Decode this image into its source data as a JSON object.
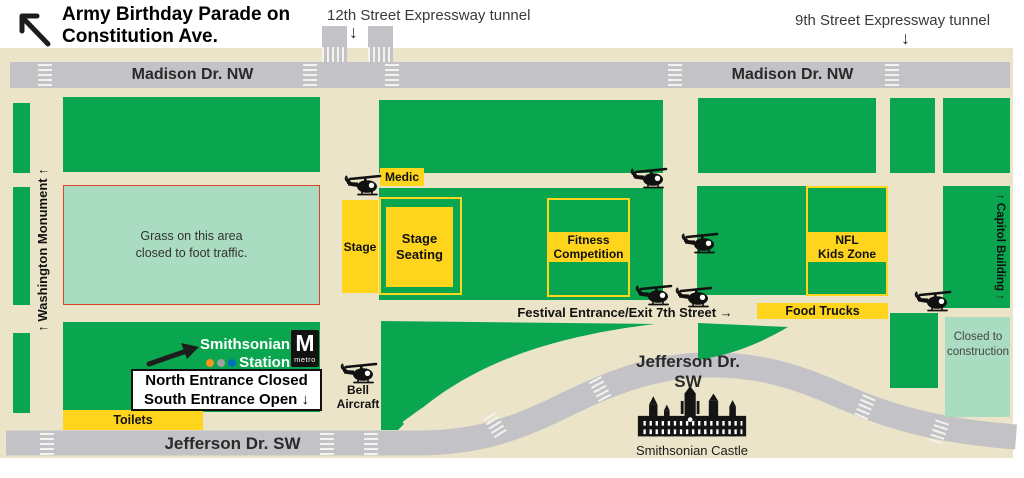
{
  "title": {
    "line1": "Army Birthday Parade on",
    "line2": "Constitution Ave."
  },
  "tunnels": {
    "t12": "12th Street Expressway tunnel",
    "t9": "9th Street Expressway tunnel",
    "down_arrow": "↓"
  },
  "streets": {
    "madison_left": "Madison Dr. NW",
    "madison_right": "Madison Dr. NW",
    "jefferson_left": "Jefferson Dr. SW",
    "jefferson_right": "Jefferson Dr. SW"
  },
  "landmarks": {
    "washington_monument": "↑ Washington Monument ↑",
    "capitol_building": "↑ Capitol Building ↑",
    "smithsonian_castle": "Smithsonian Castle",
    "grass_line1": "Grass on this area",
    "grass_line2": "closed to foot traffic.",
    "construction_line1": "Closed to",
    "construction_line2": "construction"
  },
  "zones": {
    "medic": "Medic",
    "stage": "Stage",
    "stage_seating_line1": "Stage",
    "stage_seating_line2": "Seating",
    "fitness_line1": "Fitness",
    "fitness_line2": "Competition",
    "nfl_line1": "NFL",
    "nfl_line2": "Kids Zone",
    "food_trucks": "Food Trucks",
    "toilets": "Toilets",
    "festival_entrance": "Festival Entrance/Exit 7th Street →",
    "bell_line1": "Bell",
    "bell_line2": "Aircraft"
  },
  "metro": {
    "station_line1": "Smithsonian",
    "station_line2": "Station",
    "logo_letter": "M",
    "logo_word": "metro",
    "entrance_line1": "North Entrance Closed",
    "entrance_line2": "South Entrance Open ↓",
    "line_colors": [
      "#f7941d",
      "#a0a2a0",
      "#0072bc"
    ]
  },
  "colors": {
    "park_green": "#0aa64f",
    "closed_green": "#a9dcc1",
    "event_yellow": "#ffd41d",
    "road_gray": "#c3c3c7",
    "map_tan": "#ece4c8",
    "grass_border_red": "#d9432f"
  }
}
